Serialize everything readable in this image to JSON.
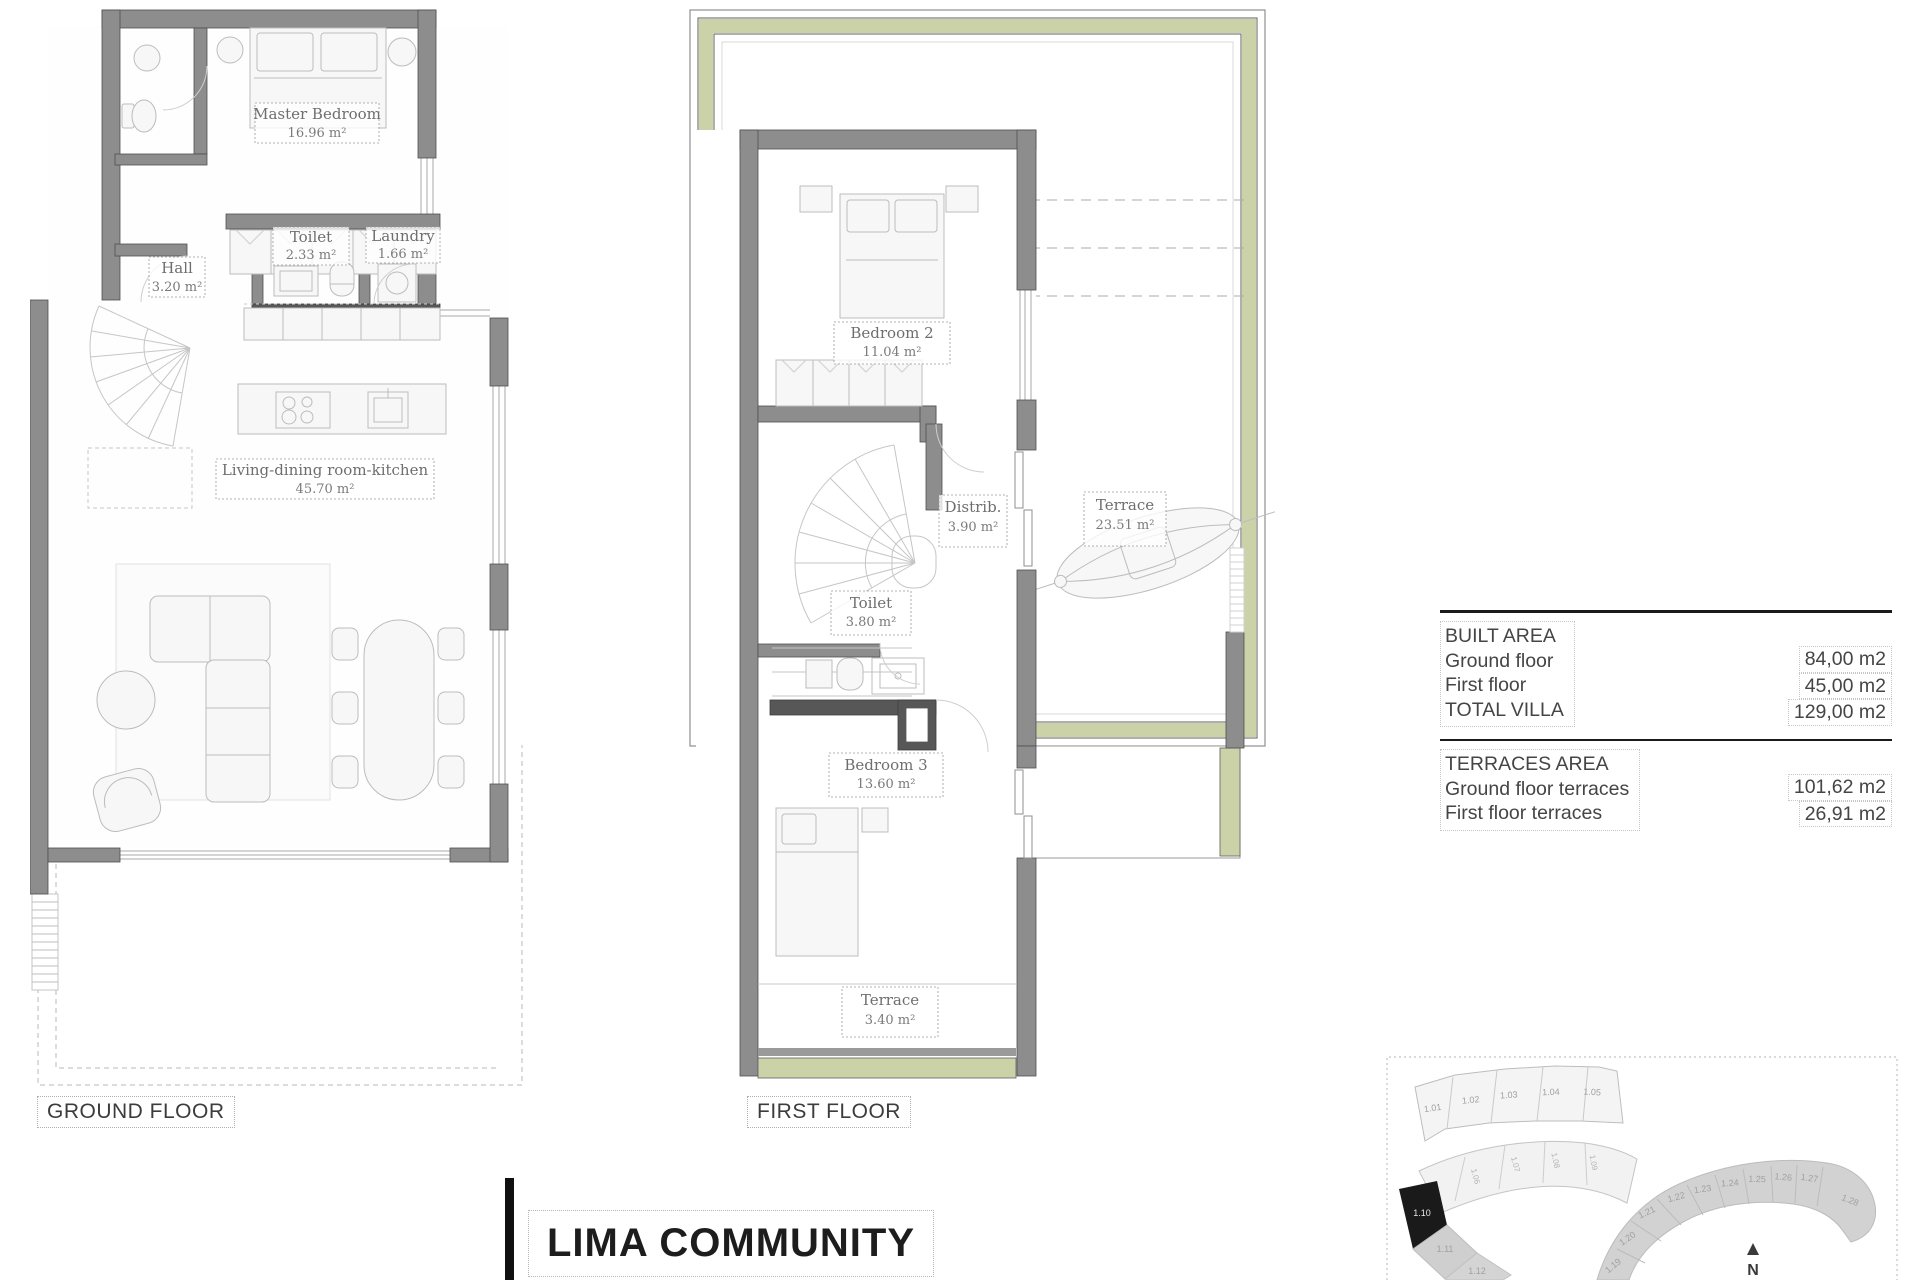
{
  "title": {
    "text": "LIMA COMMUNITY"
  },
  "sheet": {
    "ground_caption": "GROUND FLOOR",
    "first_caption": "FIRST FLOOR"
  },
  "ground_floor": {
    "rooms": {
      "master_bedroom": {
        "name": "Master Bedroom",
        "area": "16.96 m²"
      },
      "toilet": {
        "name": "Toilet",
        "area": "2.33 m²"
      },
      "laundry": {
        "name": "Laundry",
        "area": "1.66 m²"
      },
      "hall": {
        "name": "Hall",
        "area": "3.20 m²"
      },
      "living": {
        "name": "Living-dining room-kitchen",
        "area": "45.70 m²"
      }
    }
  },
  "first_floor": {
    "rooms": {
      "bedroom2": {
        "name": "Bedroom 2",
        "area": "11.04 m²"
      },
      "distrib": {
        "name": "Distrib.",
        "area": "3.90 m²"
      },
      "terrace": {
        "name": "Terrace",
        "area": "23.51 m²"
      },
      "toilet": {
        "name": "Toilet",
        "area": "3.80 m²"
      },
      "bedroom3": {
        "name": "Bedroom 3",
        "area": "13.60 m²"
      },
      "terrace_small": {
        "name": "Terrace",
        "area": "3.40 m²"
      }
    }
  },
  "area_table": {
    "built": {
      "header": "BUILT AREA",
      "rows": [
        {
          "label": "Ground floor",
          "value": "84,00 m2"
        },
        {
          "label": "First floor",
          "value": "45,00 m2"
        },
        {
          "label": "TOTAL VILLA",
          "value": "129,00 m2"
        }
      ]
    },
    "terraces": {
      "header": "TERRACES AREA",
      "rows": [
        {
          "label": "Ground floor terraces",
          "value": "101,62 m2"
        },
        {
          "label": "First floor terraces",
          "value": "26,91 m2"
        }
      ]
    }
  },
  "site_map": {
    "north_label": "N",
    "highlighted_plot": "1.10",
    "row_top": [
      "1.01",
      "1.02",
      "1.03",
      "1.04",
      "1.05"
    ],
    "row_mid": [
      "1.06",
      "1.07",
      "1.08",
      "1.09"
    ],
    "left_plots": [
      "1.10",
      "1.11",
      "1.12"
    ],
    "right_plots": [
      "1.19",
      "1.20",
      "1.21",
      "1.22",
      "1.23",
      "1.24",
      "1.25",
      "1.26",
      "1.27",
      "1.28"
    ]
  },
  "colors": {
    "wall": "#8d8d8d",
    "wall_dark": "#575757",
    "terrace_band": "#ccd2a7",
    "plot_highlight": "#1a1a1a"
  }
}
